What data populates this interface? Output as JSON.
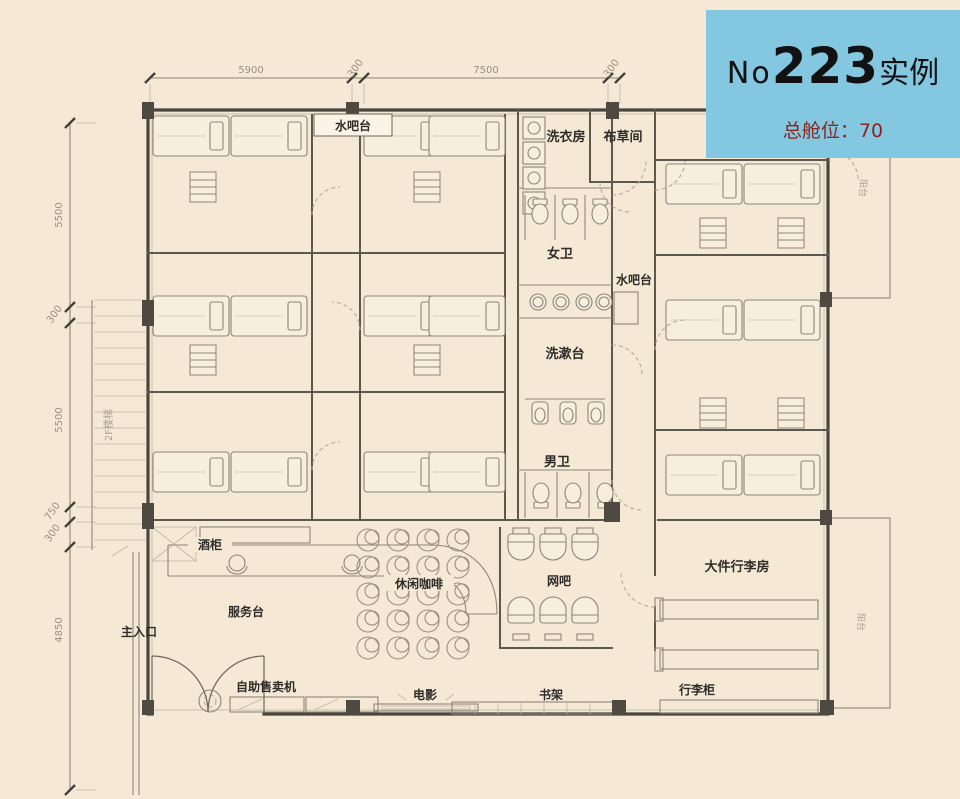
{
  "badge": {
    "prefix": "No",
    "number": "223",
    "suffix": "实例",
    "capacity": "总舱位：70"
  },
  "dimensions": {
    "top": [
      "5900",
      "300",
      "7500",
      "300"
    ],
    "left": [
      "5500",
      "300",
      "5500",
      "750",
      "300",
      "4850"
    ]
  },
  "labels": {
    "water_bar_top": "水吧台",
    "laundry_room": "洗衣房",
    "linen_room": "布草间",
    "womens_toilet": "女卫",
    "water_bar_mid": "水吧台",
    "washing_counter": "洗漱台",
    "mens_toilet": "男卫",
    "wine_cabinet": "酒柜",
    "service_desk": "服务台",
    "main_entrance": "主入口",
    "leisure_coffee": "休闲咖啡",
    "internet_cafe": "网吧",
    "luggage_room": "大件行李房",
    "vending_machine": "自助售卖机",
    "movie": "电影",
    "bookshelf": "书架",
    "luggage_locker": "行李柜",
    "stairs_2f": "2F楼梯",
    "balcony_top": "阳台",
    "balcony_bottom": "阳台"
  },
  "colors": {
    "background": "#f5e9d6",
    "wall": "#57524a",
    "line_light": "#8d8578",
    "badge_bg": "#84c7e1",
    "badge_accent": "#8a251c",
    "dim_text": "#9a9183"
  }
}
